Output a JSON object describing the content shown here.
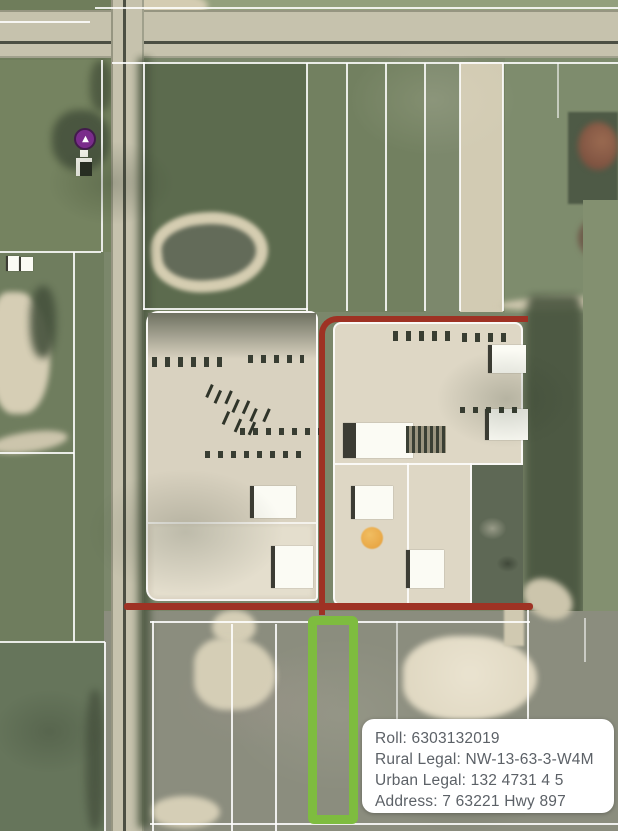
{
  "map": {
    "description": "aerial-parcel-map",
    "info_card": {
      "roll": "Roll: 6303132019",
      "rural_legal": "Rural Legal: NW-13-63-3-W4M",
      "urban_legal": "Urban Legal: 132 4731 4 5",
      "address": "Address: 7 63221 Hwy 897"
    },
    "colors": {
      "boundary_red": "#a33122",
      "highlight_green": "#7cbd3a",
      "marker_purple": "#7d2b8f",
      "marker_orange": "#e89b2e",
      "card_text": "#5c6167",
      "card_background": "#ffffff"
    }
  }
}
